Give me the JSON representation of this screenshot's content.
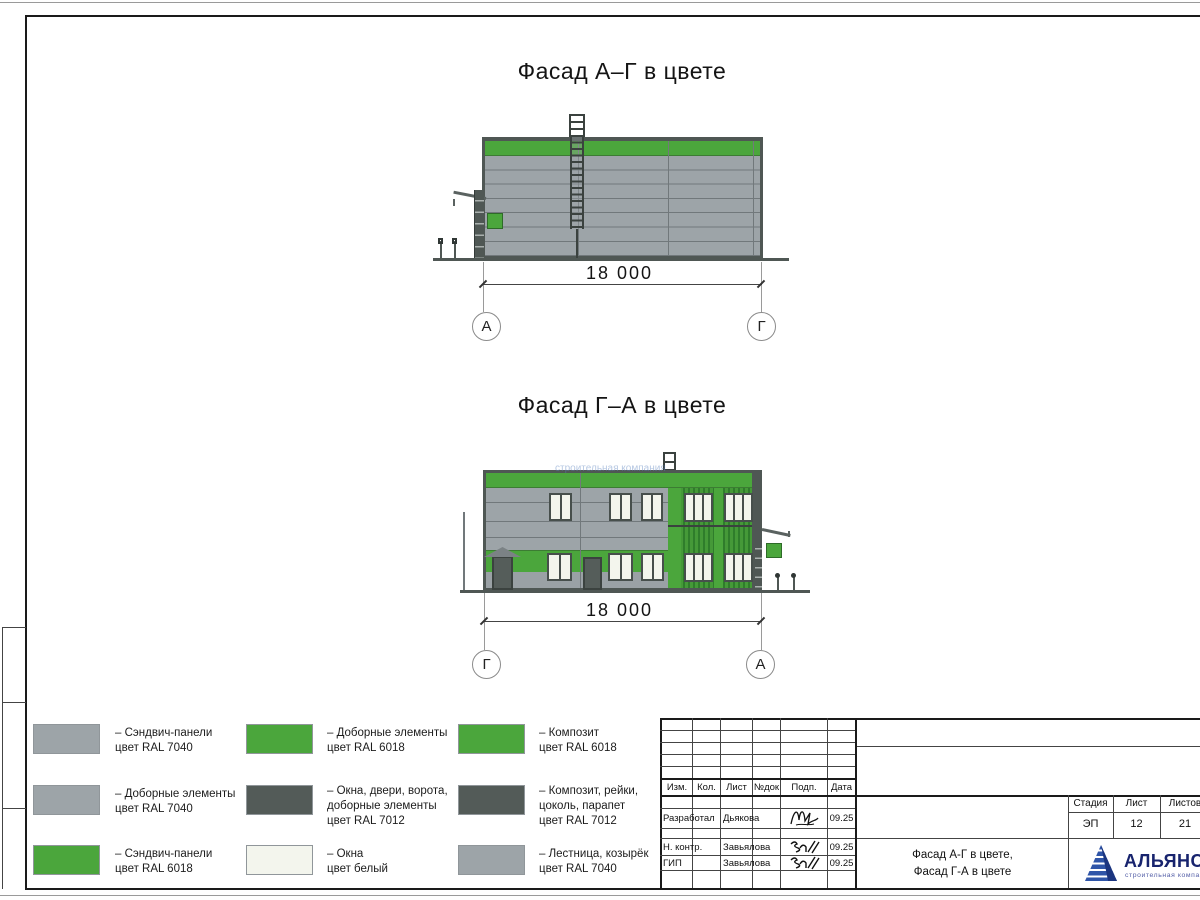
{
  "colors": {
    "ral7040": "#9da4a8",
    "ral6018": "#4ba63c",
    "ral7012": "#535b58",
    "white_win": "#f3f5ed",
    "frame_dark": "#4f5754",
    "logo_blue": "#18246e"
  },
  "facade1": {
    "title": "Фасад А–Г в цвете",
    "dimension": "18 000",
    "axis_left": "А",
    "axis_right": "Г"
  },
  "facade2": {
    "title": "Фасад Г–А в цвете",
    "dimension": "18 000",
    "axis_left": "Г",
    "axis_right": "А",
    "watermark": "строительная компания"
  },
  "legend_items": [
    {
      "swatch": "ral7040",
      "text": "– Сэндвич-панели\nцвет RAL 7040"
    },
    {
      "swatch": "ral7040",
      "text": "– Доборные элементы\nцвет RAL 7040"
    },
    {
      "swatch": "ral6018",
      "text": "– Сэндвич-панели\nцвет RAL 6018"
    },
    {
      "swatch": "ral6018",
      "text": "– Доборные элементы\nцвет RAL 6018"
    },
    {
      "swatch": "ral7012",
      "text": "– Окна, двери, ворота,\nдоборные элементы\nцвет RAL 7012"
    },
    {
      "swatch": "white_win",
      "text": "– Окна\nцвет белый"
    },
    {
      "swatch": "ral6018",
      "text": "– Композит\nцвет RAL 6018"
    },
    {
      "swatch": "ral7012",
      "text": "– Композит, рейки,\nцоколь, парапет\nцвет RAL 7012"
    },
    {
      "swatch": "ral7040",
      "text": "– Лестница, козырёк\nцвет RAL 7040"
    }
  ],
  "titleblock": {
    "header": {
      "izm": "Изм.",
      "kol": "Кол.",
      "list": "Лист",
      "doc": "№док",
      "podp": "Подп.",
      "data": "Дата"
    },
    "rows": [
      {
        "role": "Разработал",
        "name": "Дьякова",
        "date": "09.25"
      },
      {
        "role": "Н. контр.",
        "name": "Завьялова",
        "date": "09.25"
      },
      {
        "role": "ГИП",
        "name": "Завьялова",
        "date": "09.25"
      }
    ],
    "doc_title_line1": "Фасад А-Г в цвете,",
    "doc_title_line2": "Фасад Г-А в цвете",
    "stage_label": "Стадия",
    "sheet_label": "Лист",
    "sheets_label": "Листов",
    "stage": "ЭП",
    "sheet_num": "12",
    "sheets_total": "21",
    "logo": {
      "name": "АЛЬЯНС",
      "tagline": "строительная компания"
    }
  }
}
